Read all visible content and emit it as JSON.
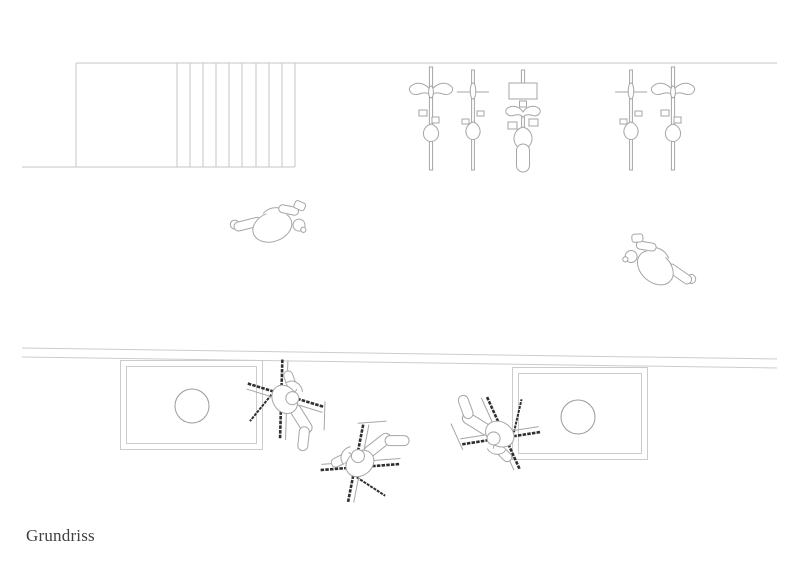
{
  "plan": {
    "label": "Grundriss",
    "type": "architectural floor plan line drawing",
    "elements": {
      "staircase": {
        "description": "stair run with landing at top left",
        "tread_lines": 10
      },
      "bicycle_row": {
        "count": 5,
        "types": [
          "swept-handlebar",
          "straight-handlebar",
          "cargo-with-basket",
          "straight-handlebar",
          "swept-handlebar"
        ]
      },
      "walking_figures": {
        "count": 2
      },
      "wall_band": {
        "description": "long shallow double line across lower half"
      },
      "tables": {
        "count": 2,
        "plates_per_table": 1
      },
      "seated_figures": {
        "count": 3,
        "description": "people in lounge chairs, plan view"
      }
    },
    "colors": {
      "background": "#ffffff",
      "line_light": "#cccccc",
      "line_mid": "#a6a6a6",
      "line_dark": "#2f2f2f",
      "text": "#414141"
    }
  }
}
